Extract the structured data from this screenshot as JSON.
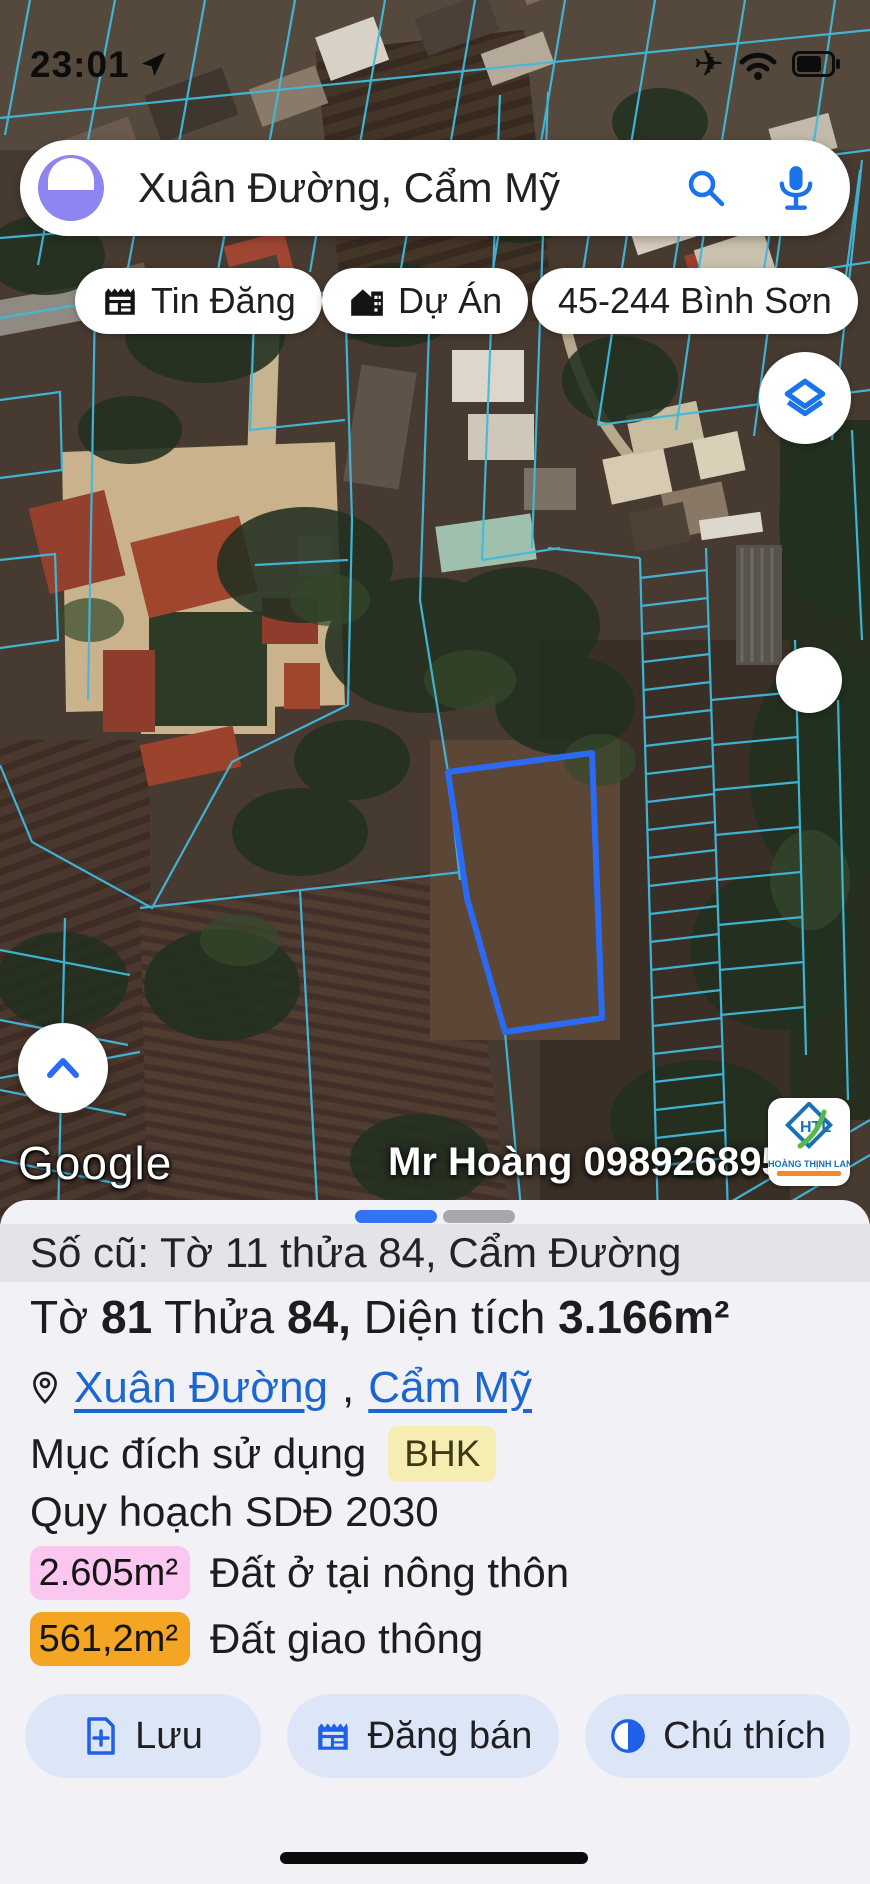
{
  "status_bar": {
    "time": "23:01"
  },
  "search": {
    "query": "Xuân Đường, Cẩm Mỹ"
  },
  "chips": [
    {
      "label": "Tin Đăng"
    },
    {
      "label": "Dự Án"
    },
    {
      "label": "45-244 Bình Sơn"
    }
  ],
  "map": {
    "google_logo": "Google",
    "watermark": "Mr Hoàng 0989268955",
    "brand_logo": {
      "name": "HOÀNG THỊNH LAND"
    }
  },
  "sheet": {
    "old_id": "Số cũ: Tờ 11 thửa 84, Cẩm Đường",
    "parcel_line": {
      "to_label": "Tờ ",
      "to_value": "81",
      "thua_label": " Thửa ",
      "thua_value": "84,",
      "area_label": " Diện tích ",
      "area_value": "3.166m²"
    },
    "location": {
      "link1": "Xuân Đường",
      "separator": ",",
      "link2": "Cẩm Mỹ"
    },
    "purpose": {
      "label": "Mục đích sử dụng",
      "badge": "BHK"
    },
    "planning_title": "Quy hoạch SDĐ 2030",
    "zones": [
      {
        "area": "2.605m²",
        "label": "Đất ở tại nông thôn",
        "color": "#fbc6ef"
      },
      {
        "area": "561,2m²",
        "label": "Đất giao thông",
        "color": "#f5a524"
      }
    ],
    "buttons": [
      {
        "label": "Lưu"
      },
      {
        "label": "Đăng bán"
      },
      {
        "label": "Chú thích"
      }
    ]
  },
  "colors": {
    "accent_blue": "#1a73e8",
    "link_blue": "#1b66d2",
    "parcel_outline": "#2b6bf3",
    "cadastral_line": "#41b9dc",
    "badge_bhk_bg": "#f6edb2",
    "badge_pink_bg": "#fbc6ef",
    "badge_orange_bg": "#f5a524",
    "button_bg": "#dde6f7",
    "sheet_bg": "#f2f1f6"
  }
}
